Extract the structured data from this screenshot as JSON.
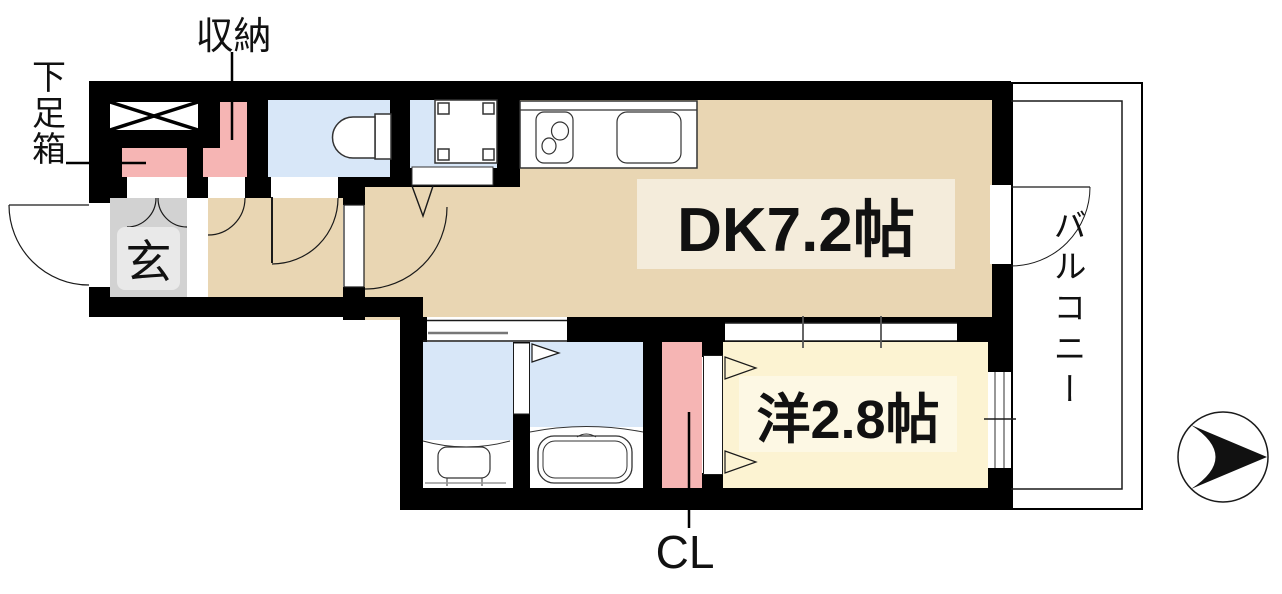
{
  "title": "間取り図",
  "labels": {
    "storage": "収納",
    "shoe_box": "下足箱",
    "entrance": "玄",
    "dining_kitchen": "DK7.2帖",
    "western_room": "洋2.8帖",
    "closet": "CL",
    "balcony": "バルコニー"
  },
  "rooms": [
    {
      "name": "dining-kitchen",
      "label": "DK7.2帖",
      "size_tatami": 7.2
    },
    {
      "name": "western-room",
      "label": "洋2.8帖",
      "size_tatami": 2.8
    },
    {
      "name": "entrance",
      "label": "玄"
    },
    {
      "name": "balcony",
      "label": "バルコニー"
    },
    {
      "name": "closet",
      "label": "CL"
    },
    {
      "name": "storage",
      "label": "収納"
    },
    {
      "name": "shoe-box",
      "label": "下足箱"
    }
  ],
  "icons": {
    "compass": "north-arrow-icon"
  },
  "colors": {
    "wall": "#000000",
    "floor-dk": "#e9d6b3",
    "floor-western": "#fcf3d2",
    "wet-area": "#d8e7f8",
    "closet-pink": "#f6b5b4",
    "entrance-gray": "#d2d2d2",
    "dk-label-bg": "#f4ecdb",
    "western-label-bg": "#fdf8e4",
    "entrance-label-bg": "#e9e9e9",
    "line": "#1a1a1a"
  }
}
